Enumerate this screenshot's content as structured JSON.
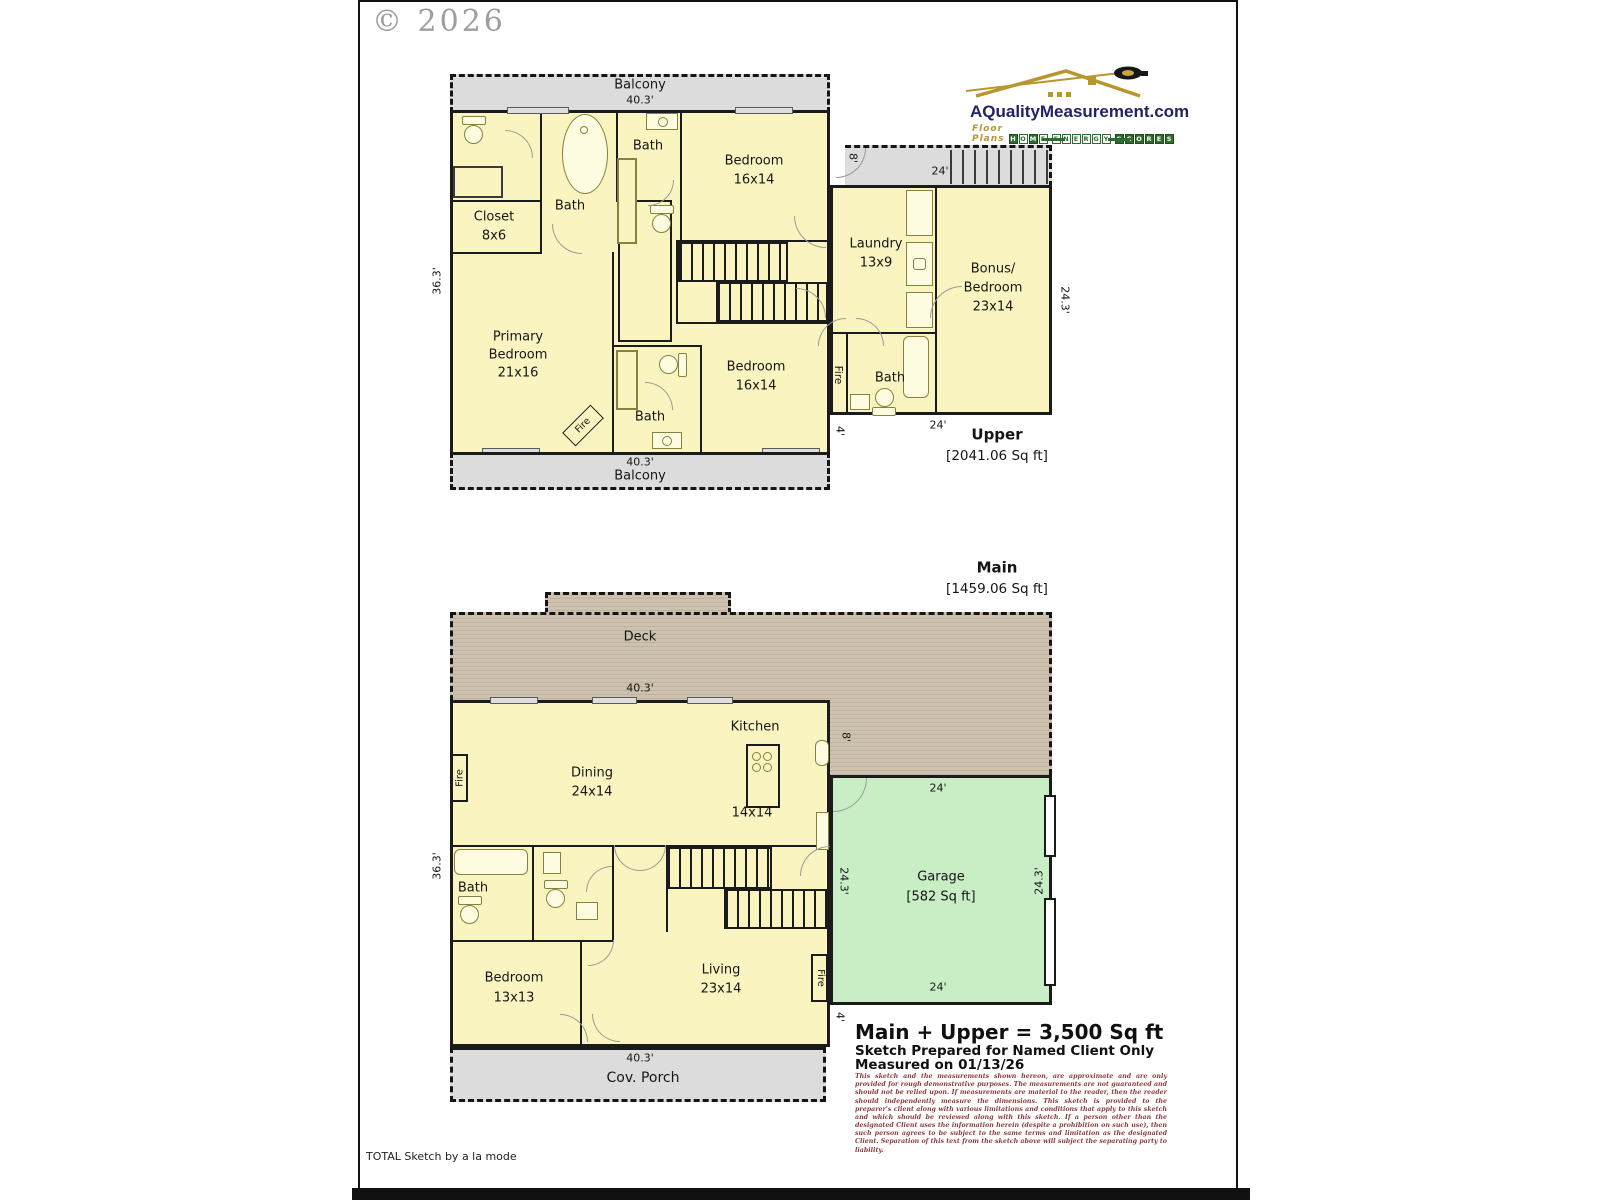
{
  "page": {
    "copyright": "© 2026",
    "credit": "TOTAL Sketch by a la mode"
  },
  "logo": {
    "site": "AQualityMeasurement.com",
    "tagline": "Floor Plans &",
    "badge1": "HOME",
    "badge2": "ENERGY",
    "badge3": "SCORES"
  },
  "floors": {
    "upper_title": "Upper",
    "upper_area": "[2041.06 Sq ft]",
    "main_title": "Main",
    "main_area": "[1459.06 Sq ft]"
  },
  "labels": {
    "balcony": "Balcony",
    "bath": "Bath",
    "closet": "Closet",
    "closet_size": "8x6",
    "bedroom": "Bedroom",
    "bedroom_16": "16x14",
    "laundry": "Laundry",
    "laundry_size": "13x9",
    "bonus_l1": "Bonus/",
    "bonus_l2": "Bedroom",
    "bonus_size": "23x14",
    "primary_l1": "Primary",
    "primary_l2": "Bedroom",
    "primary_size": "21x16",
    "fire": "Fire",
    "deck": "Deck",
    "kitchen": "Kitchen",
    "kitchen_size": "14x14",
    "dining": "Dining",
    "dining_size": "24x14",
    "living": "Living",
    "living_size": "23x14",
    "bedroom_13": "13x13",
    "garage": "Garage",
    "garage_area": "[582 Sq ft]",
    "porch": "Cov. Porch"
  },
  "dims": {
    "w403": "40.3'",
    "h363": "36.3'",
    "w24": "24'",
    "h243": "24.3'",
    "d4": "4'",
    "d8": "8'"
  },
  "summary": {
    "total": "Main + Upper = 3,500 Sq ft",
    "prepared": "Sketch Prepared for Named Client Only",
    "measured": "Measured on 01/13/26",
    "disclaimer": "This sketch and the measurements shown hereon, are approximate and are only provided for rough demonstrative purposes. The measurements are not guaranteed and should not be relied upon. If measurements are material to the reader, then the reader should independently measure the dimensions. This sketch is provided to the preparer's client along with various limitations and conditions that apply to this sketch and which should be reviewed along with this sketch. If a person other than the designated Client uses the information herein (despite a prohibition on such use), then such person agrees to be subject to the same terms and limitation as the designated Client. Separation of this text from the sketch above will subject the separating party to liability."
  }
}
